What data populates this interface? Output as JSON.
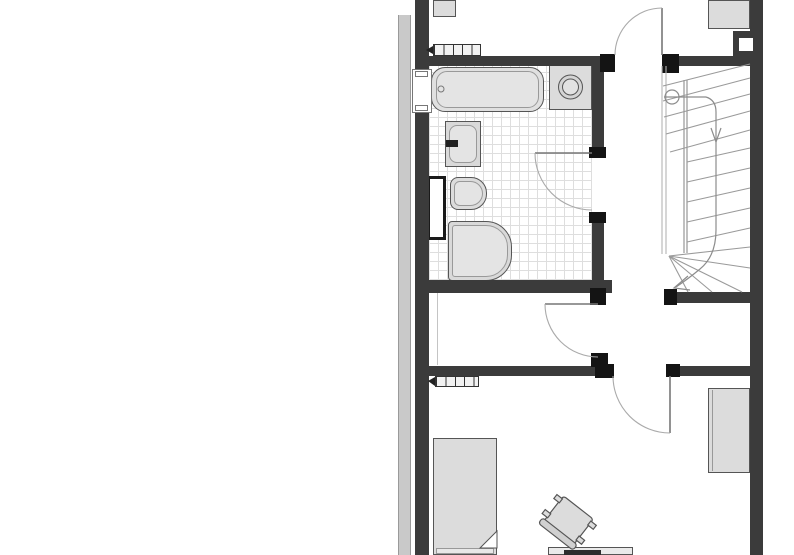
{
  "document": {
    "type": "architectural-floor-plan",
    "visible_text": [],
    "colors": {
      "background": "#ffffff",
      "wall": "#3b3b3b",
      "door_jamb": "#141414",
      "neighbor_party_wall": "#c9c9c9",
      "furniture_fill": "#dcdcdc",
      "furniture_border": "#555555",
      "tile_grid": "#dedede",
      "stair_tread_line": "#9a9a9a",
      "door_swing_line": "#aaaaaa"
    },
    "rooms": {
      "bathroom": {
        "fixtures": [
          "bathtub",
          "washing-machine",
          "sink",
          "toilet",
          "shower-tray",
          "duct-niche",
          "tiled-floor"
        ]
      },
      "stairwell": {
        "fixtures": [
          "winder-staircase",
          "walk-line",
          "start-circle"
        ]
      },
      "hallway": {
        "fixtures": [
          "radiator"
        ]
      },
      "bedroom": {
        "fixtures": [
          "bed",
          "desk",
          "desk-chair",
          "wardrobe",
          "radiator"
        ]
      },
      "top-rooms": {
        "fixtures": [
          "cabinet",
          "wardrobe",
          "radiator",
          "shaft"
        ]
      }
    },
    "openings": [
      "window-left-wall",
      "door-top-room",
      "door-bathroom",
      "door-hallway",
      "door-bedroom"
    ]
  }
}
